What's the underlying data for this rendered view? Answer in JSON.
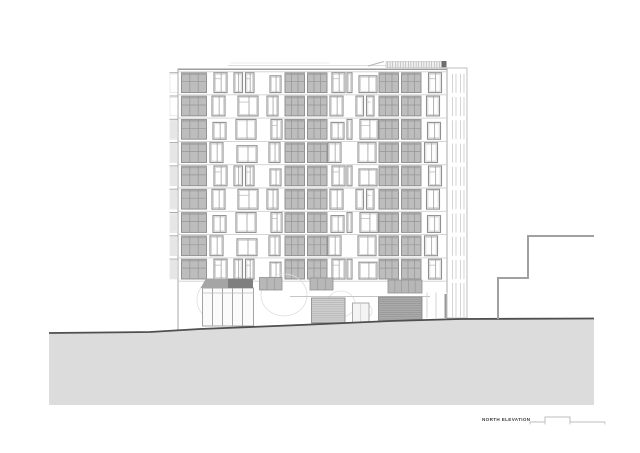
{
  "title_block": {
    "label": "NORTH ELEVATION"
  },
  "colors": {
    "paper": "#ffffff",
    "facade_outline": "#a8a8a8",
    "floor_line": "#cfcfcf",
    "parapet_line": "#9c9c9c",
    "glazing_fill": "#bdbdbd",
    "glazing_mullion": "#959595",
    "glazing_band": "#a6a6a6",
    "window_frame": "#8f8f8f",
    "window_inner": "#c4c4c4",
    "ground_fill": "#dcdcdc",
    "ground_line": "#4f4f4f",
    "neighbor_line": "#a0a0a0",
    "canopy_fill": "#a5a5a5",
    "canopy_dark": "#7f7f7f",
    "garage_light": "#cfcfcf",
    "garage_dark": "#ababab",
    "tree_line": "#e0e0e0",
    "roof_louver": "#adadad",
    "roof_cap": "#6e6e6e",
    "scalebar_line": "#bdbdbd",
    "title_color": "#3d3d3d"
  },
  "elevation": {
    "canvas": {
      "w": 640,
      "h": 453
    },
    "building": {
      "left": 178,
      "right": 447,
      "top": 69,
      "base": 334,
      "wing": {
        "x": 447,
        "w": 20,
        "top": 68,
        "base": 318,
        "louver_xs": [
          452.5,
          456,
          460.5,
          464
        ]
      },
      "floors": 9,
      "first_floor_y": 71.5,
      "floor_h": 23.3,
      "window_h": 19.8
    },
    "columns": [
      {
        "type": "glazed",
        "x": 181.5,
        "w": 25
      },
      {
        "type": "win",
        "x": 212,
        "w": 13
      },
      {
        "type": "win",
        "x": 236,
        "w": 20
      },
      {
        "type": "win",
        "x": 269,
        "w": 11
      },
      {
        "type": "glazed2",
        "x": 285,
        "w": 42
      },
      {
        "type": "win",
        "x": 330,
        "w": 13
      },
      {
        "type": "win_sm",
        "x": 347,
        "w": 5
      },
      {
        "type": "win",
        "x": 358,
        "w": 18
      },
      {
        "type": "glazed2",
        "x": 379,
        "w": 42
      },
      {
        "type": "win",
        "x": 426.5,
        "w": 13
      }
    ],
    "roof": {
      "faint_line": "228,65.5 388,65.5",
      "faint_line2": "230,63 330,63",
      "diagonal": "368,66 384,61.5",
      "louver_band": {
        "x": 386,
        "y": 61.5,
        "w": 56,
        "h": 6,
        "tick_step": 2.6
      },
      "end_cap": {
        "x": 441.5,
        "y": 61,
        "w": 5,
        "h": 6.5
      }
    },
    "ground_floor": {
      "canopy_pts": "200.5,288 206,278.5 247,278.5 253,288",
      "canopy_dark": {
        "x": 228,
        "y": 278.5,
        "w": 25,
        "h": 9.5
      },
      "storefront": {
        "x": 202.5,
        "y": 288,
        "w": 51,
        "h": 38,
        "mullion_xs": [
          212.5,
          222.5,
          232.5,
          242.5
        ],
        "transom_y": 293
      },
      "transoms": [
        {
          "x": 259.5,
          "y": 277.5,
          "w": 22.5,
          "h": 12.5,
          "mullions": 2
        },
        {
          "x": 310,
          "y": 278,
          "w": 23,
          "h": 12,
          "mullions": 2
        },
        {
          "x": 388,
          "y": 280,
          "w": 34,
          "h": 13,
          "mullions": 4
        }
      ],
      "lintel": "290,296.5 430,296.5",
      "garage_left": {
        "x": 311.5,
        "y": 298,
        "w": 33.5,
        "h": 25
      },
      "garage_right": {
        "x": 378.5,
        "y": 297,
        "w": 43.5,
        "h": 25
      },
      "door": {
        "x": 352.5,
        "y": 303,
        "w": 16.5,
        "h": 21
      },
      "dark_bar": {
        "x": 444.5,
        "y": 294,
        "w": 3,
        "h": 24
      },
      "bay_line_xs": [
        427,
        436,
        447
      ],
      "trees": [
        {
          "cx": 214,
          "cy": 300,
          "rx": 17,
          "ry": 19
        },
        {
          "cx": 284,
          "cy": 295,
          "rx": 23,
          "ry": 21
        },
        {
          "cx": 341,
          "cy": 304,
          "rx": 14,
          "ry": 13
        },
        {
          "cx": 365,
          "cy": 311,
          "rx": 7,
          "ry": 7
        }
      ]
    },
    "ground": {
      "top_pts": "49,333 150,332 200,329 300,325 390,321 460,319 594,318.5",
      "fill_pts": "49,333 150,332 200,329 300,325 390,321 460,319 594,318.5 594,405 49,405"
    },
    "neighbor_pts": "498,319 498,278 528,278 528,236 594,236",
    "scale_bar": {
      "pts": "530,422 545,422 545,417 570,417 570,422 605,422",
      "tick_xs": [
        530,
        545,
        570,
        605
      ],
      "tick_len": 2.5
    }
  }
}
